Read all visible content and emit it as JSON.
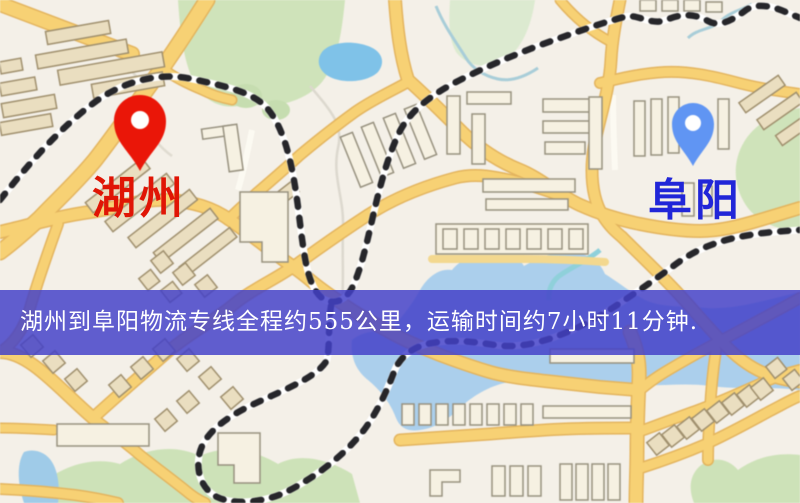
{
  "map": {
    "origin_marker": {
      "label": "湖州",
      "label_color": "#e01505",
      "pin_color": "#ea1608"
    },
    "destination_marker": {
      "label": "阜阳",
      "label_color": "#2126d8",
      "pin_color": "#6095f3"
    },
    "banner": {
      "text": "湖州到阜阳物流专线全程约555公里，运输时间约7小时11分钟.",
      "background_color": "#4340c8",
      "text_color": "#ffffff"
    },
    "palette": {
      "background": "#f4f0e8",
      "road": "#f7d174",
      "road_casing": "#e3b45e",
      "park": "#cfe3ba",
      "water": "#a3cfee",
      "building_tan": "#eadec0",
      "building_light": "#f6f1e2",
      "railway": "#26262a"
    }
  }
}
